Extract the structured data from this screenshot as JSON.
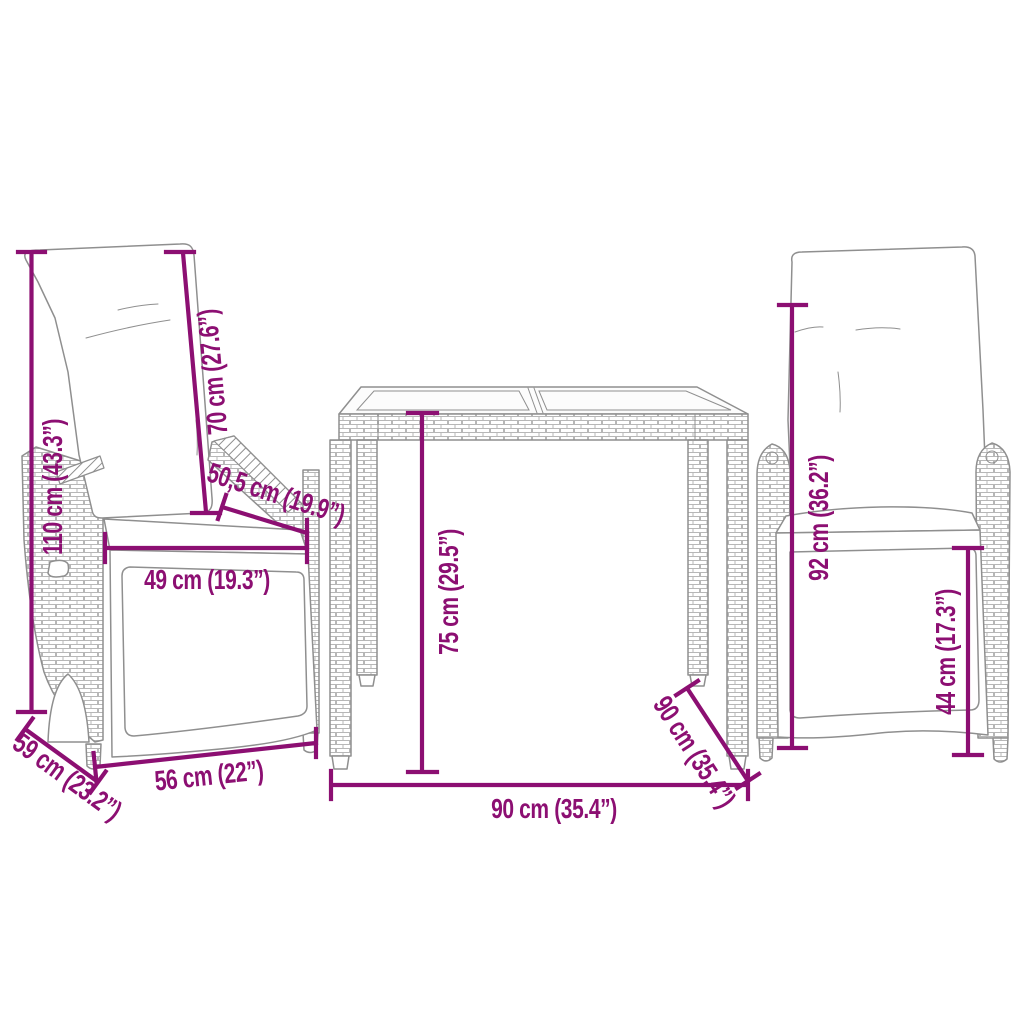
{
  "colors": {
    "dimension": "#8c0f72",
    "line_art": "#8f8f8f"
  },
  "dimensions": [
    {
      "id": "left-chair-total-height",
      "text": "110 cm (43.3”)"
    },
    {
      "id": "backrest-height",
      "text": "70 cm (27.6”)"
    },
    {
      "id": "armrest-depth",
      "text": "50,5 cm (19.9”)"
    },
    {
      "id": "seat-width",
      "text": "49 cm (19.3”)"
    },
    {
      "id": "chair-front-width",
      "text": "56 cm (22”)"
    },
    {
      "id": "chair-depth",
      "text": "59 cm (23.2”)"
    },
    {
      "id": "table-height",
      "text": "75 cm (29.5”)"
    },
    {
      "id": "table-width",
      "text": "90 cm (35.4”)"
    },
    {
      "id": "table-depth",
      "text": "90 cm (35.4”)"
    },
    {
      "id": "right-chair-height",
      "text": "92 cm (36.2”)"
    },
    {
      "id": "seat-height",
      "text": "44 cm (17.3”)"
    }
  ]
}
